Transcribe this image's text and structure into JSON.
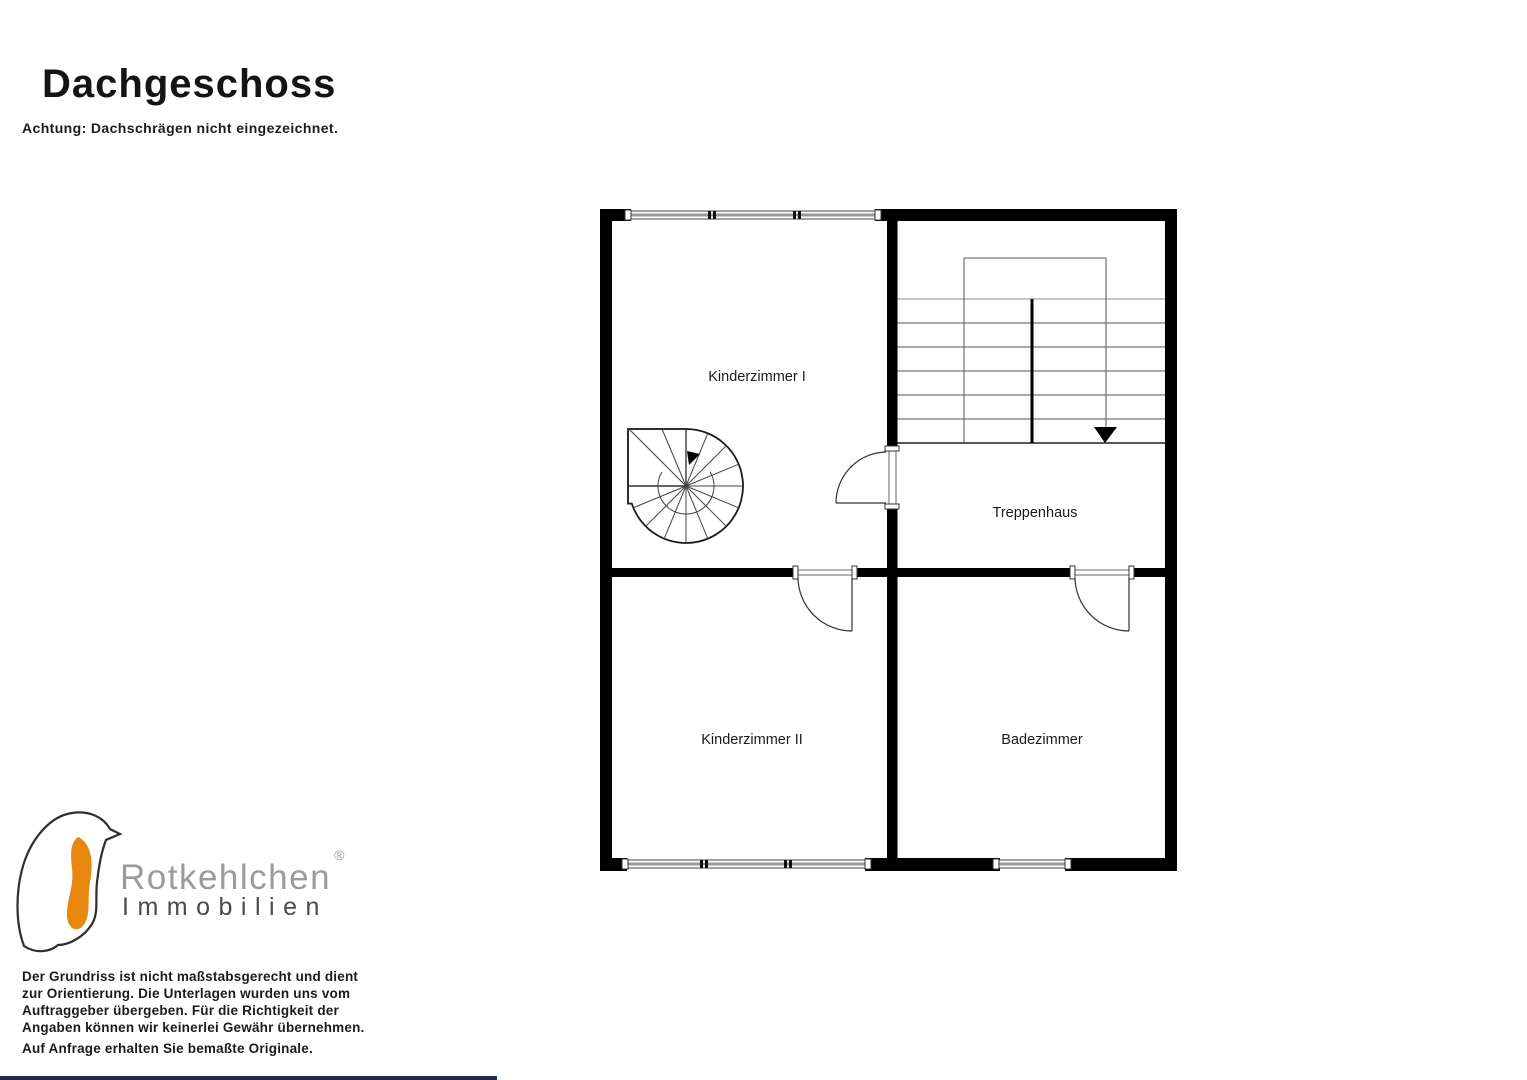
{
  "header": {
    "title": "Dachgeschoss",
    "subtitle": "Achtung: Dachschrägen nicht eingezeichnet."
  },
  "plan": {
    "rooms": [
      {
        "name": "kinderzimmer-1",
        "label": "Kinderzimmer I"
      },
      {
        "name": "treppenhaus",
        "label": "Treppenhaus"
      },
      {
        "name": "kinderzimmer-2",
        "label": "Kinderzimmer II"
      },
      {
        "name": "badezimmer",
        "label": "Badezimmer"
      }
    ]
  },
  "logo": {
    "brand": "Rotkehlchen",
    "registered_mark": "®",
    "line2": "Immobilien",
    "bird_icon": "robin-bird-icon"
  },
  "footer": {
    "disclaimer_lines": [
      "Der Grundriss ist nicht maßstabsgerecht und dient",
      "zur Orientierung. Die Unterlagen wurden uns vom",
      "Auftraggeber übergeben. Für die Richtigkeit der",
      "Angaben können wir keinerlei Gewähr übernehmen."
    ],
    "note": "Auf Anfrage erhalten Sie bemaßte Originale."
  },
  "colors": {
    "wall": "#000000",
    "accent_orange": "#E8870F",
    "bottom_bar": "#1E2C4F",
    "logo_gray": "#9B9B9B",
    "logo_dark": "#4A4A4A"
  }
}
